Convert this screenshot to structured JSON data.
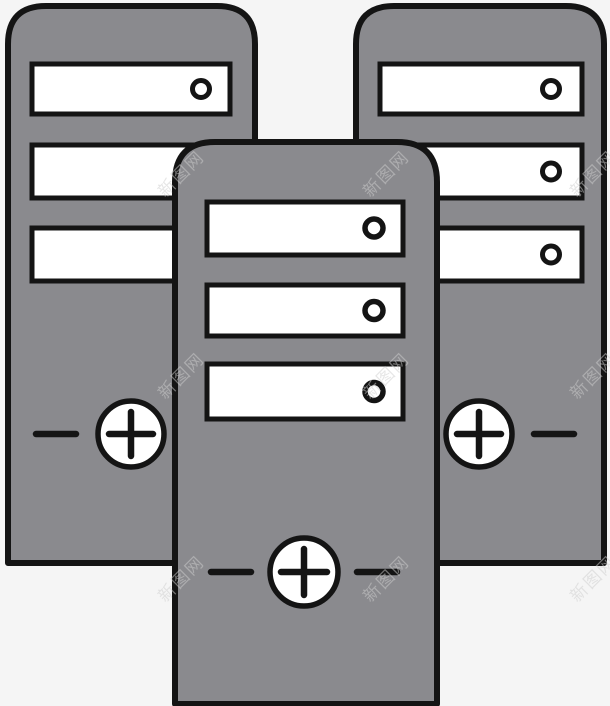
{
  "scene": {
    "kind": "stock clipart illustration",
    "subject": "three gray computer tower servers, front tower overlapping two rear towers",
    "towers": [
      {
        "id": "rear-left-tower",
        "drive_bays": 3,
        "bay_dot": "circle",
        "power_button": "circled plus with side dashes"
      },
      {
        "id": "rear-right-tower",
        "drive_bays": 3,
        "bay_dot": "circle",
        "power_button": "circled plus with side dashes"
      },
      {
        "id": "front-center-tower",
        "drive_bays": 3,
        "bay_dot": "circle",
        "power_button": "circled plus with side dashes"
      }
    ]
  },
  "watermark": {
    "text": "新图网"
  },
  "colors": {
    "background": "#f5f5f5",
    "tower_fill": "#8a8a8e",
    "outline": "#141414",
    "panel_fill": "#ffffff",
    "watermark": "#cfcfcf"
  }
}
